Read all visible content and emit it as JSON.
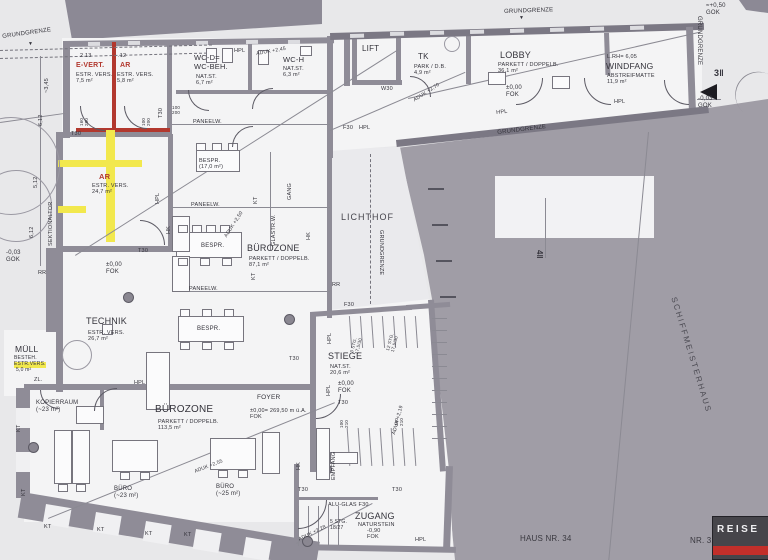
{
  "colors": {
    "paper": "#e8e8ea",
    "floor": "#f4f4f5",
    "wall": "#8f8c97",
    "wallD": "#7b7884",
    "ink": "#34333b",
    "red": "#b2382e",
    "yellow": "#f2e84d",
    "gray": "#a09da6",
    "mass": "#8c8995",
    "court": "#eaeaed",
    "white": "#f2f2f4",
    "win": "#dcdce0",
    "winB": "#f0f0f2",
    "line": "#55545e"
  },
  "footer": {
    "logo_text": "REISE",
    "house_left": "HAUS NR. 34",
    "house_right": "NR. 32"
  },
  "labels": [
    {
      "n": "grundgrenze-top-left",
      "t": "GRUNDGRENZE",
      "x": 2,
      "y": 34,
      "s": 6,
      "r": -8
    },
    {
      "n": "boundary-arrow-left",
      "t": "▼",
      "x": 28,
      "y": 42,
      "s": 5
    },
    {
      "n": "grundgrenze-top",
      "t": "GRUNDGRENZE",
      "x": 504,
      "y": 9,
      "s": 6,
      "r": -2
    },
    {
      "n": "boundary-arrow-top",
      "t": "▼",
      "x": 519,
      "y": 16,
      "s": 5
    },
    {
      "n": "grundgrenze-right",
      "t": "GRUNDGRENZE",
      "x": 702,
      "y": 16,
      "s": 6,
      "r": 90
    },
    {
      "n": "grundgrenze-diagonal",
      "t": "GRUNDGRENZE",
      "x": 497,
      "y": 130,
      "s": 6,
      "r": -7
    },
    {
      "n": "grundgrenze-lichthof",
      "t": "GRUNDGRENZE",
      "x": 384,
      "y": 230,
      "s": 5.5,
      "r": 90
    },
    {
      "n": "level-plus050-gok",
      "t": "≈+0,50\nGOK",
      "x": 706,
      "y": 3,
      "s": 6
    },
    {
      "n": "level-minus003-gok-right",
      "t": "-0,03\nGOK",
      "x": 698,
      "y": 96,
      "s": 6
    },
    {
      "n": "level-minus003-gok-left",
      "t": "-0,03\nGOK",
      "x": 6,
      "y": 250,
      "s": 6
    },
    {
      "n": "section-marker-3",
      "t": "3‖",
      "x": 714,
      "y": 68,
      "s": 9,
      "b": 1
    },
    {
      "n": "section-marker-4",
      "t": "4‖",
      "x": 544,
      "y": 250,
      "s": 8,
      "b": 1,
      "r": 90
    },
    {
      "n": "schiffmeisterhaus-label",
      "t": "SCHIFFMEISTERHAUS",
      "x": 678,
      "y": 296,
      "s": 8,
      "r": 73,
      "ls": 2,
      "c": "#4b4a52"
    },
    {
      "n": "room-evert-title",
      "t": "E-VERT.",
      "x": 76,
      "y": 62,
      "s": 7,
      "b": 1,
      "c": "#b2382e"
    },
    {
      "n": "room-evert-details",
      "t": "ESTR. VERS.\n7,5 m²",
      "x": 76,
      "y": 72,
      "s": 5.5
    },
    {
      "n": "room-ar1-title",
      "t": "AR",
      "x": 120,
      "y": 62,
      "s": 7,
      "b": 1,
      "c": "#b2382e"
    },
    {
      "n": "room-ar1-details",
      "t": "ESTR. VERS.\n5,8 m²",
      "x": 117,
      "y": 72,
      "s": 5.5
    },
    {
      "n": "room-wcd-title",
      "t": "WC-D=\nWC-BEH.",
      "x": 194,
      "y": 54,
      "s": 7.5
    },
    {
      "n": "room-wcd-details",
      "t": "NAT.ST.\n6,7 m²",
      "x": 196,
      "y": 74,
      "s": 5.5
    },
    {
      "n": "room-wch-title",
      "t": "WC-H",
      "x": 283,
      "y": 56,
      "s": 7.5
    },
    {
      "n": "room-wch-details",
      "t": "NAT.ST.\n6,3 m²",
      "x": 283,
      "y": 66,
      "s": 5.5
    },
    {
      "n": "room-lift-title",
      "t": "LIFT",
      "x": 362,
      "y": 44,
      "s": 8
    },
    {
      "n": "room-tk-title",
      "t": "TK",
      "x": 418,
      "y": 52,
      "s": 8
    },
    {
      "n": "room-tk-details",
      "t": "PARK / D.B.\n4,9 m²",
      "x": 414,
      "y": 64,
      "s": 5.5
    },
    {
      "n": "room-lobby-title",
      "t": "LOBBY",
      "x": 500,
      "y": 50,
      "s": 9
    },
    {
      "n": "room-lobby-details",
      "t": "PARKETT / DOPPELB.\n36,1 m²",
      "x": 498,
      "y": 62,
      "s": 5.5
    },
    {
      "n": "level-lobby",
      "t": "±0,00\nFOK",
      "x": 506,
      "y": 85,
      "s": 6
    },
    {
      "n": "windfang-lrh",
      "t": "L.RH= 6,05",
      "x": 607,
      "y": 54,
      "s": 5.5
    },
    {
      "n": "room-windfang-title",
      "t": "WINDFANG",
      "x": 606,
      "y": 61,
      "s": 8.5
    },
    {
      "n": "room-windfang-details",
      "t": "ABSTREIFMATTE\n11,9 m²",
      "x": 607,
      "y": 73,
      "s": 5.5
    },
    {
      "n": "room-ar2-title",
      "t": "AR",
      "x": 99,
      "y": 173,
      "s": 7.5,
      "b": 1,
      "c": "#b2382e"
    },
    {
      "n": "room-ar2-details",
      "t": "ESTR. VERS.\n24,7 m²",
      "x": 92,
      "y": 183,
      "s": 5.5
    },
    {
      "n": "room-muell-title",
      "t": "MÜLL",
      "x": 15,
      "y": 344,
      "s": 8.5
    },
    {
      "n": "room-muell-besteh",
      "t": "BESTEH.",
      "x": 14,
      "y": 356,
      "s": 5
    },
    {
      "n": "room-muell-estr",
      "t": "ESTR.VERS.",
      "x": 14,
      "y": 362,
      "s": 5,
      "bg": "#f2e84d"
    },
    {
      "n": "room-muell-area",
      "t": "5,0 m²",
      "x": 16,
      "y": 368,
      "s": 5
    },
    {
      "n": "annot-zl",
      "t": "ZL.",
      "x": 34,
      "y": 377,
      "s": 5.5
    },
    {
      "n": "room-technik-title",
      "t": "TECHNIK",
      "x": 86,
      "y": 316,
      "s": 9
    },
    {
      "n": "room-technik-details",
      "t": "ESTR. VERS.\n26,7 m²",
      "x": 88,
      "y": 330,
      "s": 5.5
    },
    {
      "n": "level-technik",
      "t": "±0,00\nFOK",
      "x": 106,
      "y": 262,
      "s": 6
    },
    {
      "n": "room-bespr-title",
      "t": "BESPR.\n(17,0 m²)",
      "x": 199,
      "y": 158,
      "s": 5.5
    },
    {
      "n": "table-bespr-1",
      "t": "BESPR.",
      "x": 201,
      "y": 243,
      "s": 6
    },
    {
      "n": "table-bespr-2",
      "t": "BESPR.",
      "x": 197,
      "y": 326,
      "s": 6
    },
    {
      "n": "room-buerozone1-title",
      "t": "BÜROZONE",
      "x": 247,
      "y": 243,
      "s": 9
    },
    {
      "n": "room-buerozone1-details",
      "t": "PARKETT / DOPPELB.\n87,1 m²",
      "x": 249,
      "y": 256,
      "s": 5.5
    },
    {
      "n": "court-lichthof-title",
      "t": "LICHTHOF",
      "x": 341,
      "y": 212,
      "s": 9,
      "ls": 1,
      "c": "#45444c"
    },
    {
      "n": "room-stiege-title",
      "t": "STIEGE",
      "x": 328,
      "y": 351,
      "s": 9
    },
    {
      "n": "room-stiege-details",
      "t": "NAT.ST.\n20,6 m²",
      "x": 330,
      "y": 364,
      "s": 5.5
    },
    {
      "n": "level-stiege",
      "t": "±0,00\nFOK",
      "x": 338,
      "y": 381,
      "s": 6
    },
    {
      "n": "room-foyer-title",
      "t": "FOYER",
      "x": 257,
      "y": 394,
      "s": 6.5
    },
    {
      "n": "level-foyer",
      "t": "±0,00= 269,50 m ü.A.\nFOK",
      "x": 250,
      "y": 408,
      "s": 5.5
    },
    {
      "n": "room-kopierraum-title",
      "t": "KOPIERRAUM\n(~23 m²)",
      "x": 36,
      "y": 400,
      "s": 6
    },
    {
      "n": "room-buerozone2-title",
      "t": "BÜROZONE",
      "x": 155,
      "y": 404,
      "s": 10
    },
    {
      "n": "room-buerozone2-details",
      "t": "PARKETT / DOPPELB.\n113,5 m²",
      "x": 158,
      "y": 419,
      "s": 5.5
    },
    {
      "n": "room-buero1-title",
      "t": "BÜRO\n(~23 m²)",
      "x": 114,
      "y": 486,
      "s": 6
    },
    {
      "n": "room-buero2-title",
      "t": "BÜRO\n(~25 m²)",
      "x": 216,
      "y": 484,
      "s": 6
    },
    {
      "n": "room-zugang-title",
      "t": "ZUGANG",
      "x": 355,
      "y": 511,
      "s": 9
    },
    {
      "n": "room-zugang-details",
      "t": "NATURSTEIN",
      "x": 358,
      "y": 522,
      "s": 5.5
    },
    {
      "n": "level-zugang",
      "t": "-0,90\nFOK",
      "x": 367,
      "y": 528,
      "s": 5.5
    },
    {
      "n": "stairs-zugang",
      "t": "5 STG.\n18/27",
      "x": 330,
      "y": 520,
      "s": 5
    },
    {
      "n": "annot-alu-glas",
      "t": "ALU-GLAS F30",
      "x": 328,
      "y": 502,
      "s": 5.5
    },
    {
      "n": "annot-empfang",
      "t": "EMPFANG",
      "x": 331,
      "y": 480,
      "s": 5.5,
      "r": -90
    },
    {
      "n": "stairs-stiege-1",
      "t": "3 STG.\n17,5/30",
      "x": 349,
      "y": 352,
      "s": 4.5,
      "r": -75
    },
    {
      "n": "stairs-stiege-2",
      "t": "12 STG.\n17,5/30",
      "x": 385,
      "y": 350,
      "s": 4.5,
      "r": -75
    },
    {
      "n": "annot-hpl-1",
      "t": "HPL",
      "x": 234,
      "y": 48,
      "s": 5.5
    },
    {
      "n": "annot-f30-1",
      "t": "F30",
      "x": 343,
      "y": 125,
      "s": 5.5
    },
    {
      "n": "annot-hpl-2",
      "t": "HPL",
      "x": 359,
      "y": 125,
      "s": 5.5
    },
    {
      "n": "annot-hpl-3",
      "t": "HPL",
      "x": 496,
      "y": 110,
      "s": 5.5,
      "r": -6
    },
    {
      "n": "annot-hpl-4",
      "t": "HPL",
      "x": 614,
      "y": 99,
      "s": 5.5
    },
    {
      "n": "annot-hpl-5",
      "t": "HPL",
      "x": 134,
      "y": 380,
      "s": 5.5
    },
    {
      "n": "annot-hpl-6",
      "t": "HPL",
      "x": 327,
      "y": 344,
      "s": 5.5,
      "r": -90
    },
    {
      "n": "annot-hpl-7",
      "t": "HPL",
      "x": 326,
      "y": 396,
      "s": 5.5,
      "r": -90
    },
    {
      "n": "annot-hpl-8",
      "t": "HPL",
      "x": 415,
      "y": 537,
      "s": 5.5
    },
    {
      "n": "annot-hpl-9",
      "t": "HPL",
      "x": 155,
      "y": 204,
      "s": 5.5,
      "r": -90
    },
    {
      "n": "annot-paneelw-1",
      "t": "PANEELW.",
      "x": 193,
      "y": 119,
      "s": 5.5
    },
    {
      "n": "annot-paneelw-2",
      "t": "PANEELW.",
      "x": 191,
      "y": 202,
      "s": 5.5
    },
    {
      "n": "annot-paneelw-3",
      "t": "PANEELW.",
      "x": 189,
      "y": 286,
      "s": 5.5
    },
    {
      "n": "annot-sektionaltor",
      "t": "SEKTIONALTOR",
      "x": 48,
      "y": 246,
      "s": 5.5,
      "r": -90
    },
    {
      "n": "annot-glastrw",
      "t": "GLASTR.W.",
      "x": 271,
      "y": 246,
      "s": 5.5,
      "r": -90
    },
    {
      "n": "annot-gang",
      "t": "GANG",
      "x": 287,
      "y": 200,
      "s": 5.5,
      "r": -90
    },
    {
      "n": "annot-w30",
      "t": "W30",
      "x": 381,
      "y": 86,
      "s": 5.5
    },
    {
      "n": "annot-f30-2",
      "t": "F30",
      "x": 344,
      "y": 302,
      "s": 5.5
    },
    {
      "n": "annot-kt-1",
      "t": "KT",
      "x": 253,
      "y": 204,
      "s": 5.5,
      "r": -90
    },
    {
      "n": "annot-kt-2",
      "t": "KT",
      "x": 251,
      "y": 280,
      "s": 5.5,
      "r": -90
    },
    {
      "n": "annot-hk-1",
      "t": "HK",
      "x": 306,
      "y": 240,
      "s": 5.5,
      "r": -90
    },
    {
      "n": "annot-hk-2",
      "t": "HK",
      "x": 296,
      "y": 470,
      "s": 5.5,
      "r": -90
    },
    {
      "n": "annot-hk-3",
      "t": "HK",
      "x": 166,
      "y": 234,
      "s": 5.5,
      "r": -90
    },
    {
      "n": "annot-rr-1",
      "t": "RR",
      "x": 38,
      "y": 270,
      "s": 5.5
    },
    {
      "n": "annot-rr-2",
      "t": "RR",
      "x": 332,
      "y": 282,
      "s": 5.5
    },
    {
      "n": "annot-kt-3",
      "t": "KT",
      "x": 16,
      "y": 432,
      "s": 5.5,
      "r": -90
    },
    {
      "n": "annot-kt-4",
      "t": "KT",
      "x": 21,
      "y": 496,
      "s": 5.5,
      "r": -90
    },
    {
      "n": "annot-kt-5",
      "t": "KT",
      "x": 44,
      "y": 524,
      "s": 5.5
    },
    {
      "n": "annot-kt-6",
      "t": "KT",
      "x": 97,
      "y": 527,
      "s": 5.5
    },
    {
      "n": "annot-kt-7",
      "t": "KT",
      "x": 145,
      "y": 531,
      "s": 5.5
    },
    {
      "n": "annot-kt-8",
      "t": "KT",
      "x": 184,
      "y": 532,
      "s": 5.5
    },
    {
      "n": "level-aduk-1",
      "t": "ADUK +2,45",
      "x": 256,
      "y": 52,
      "s": 5,
      "r": -10
    },
    {
      "n": "level-aduk-2",
      "t": "ADUK +2,70",
      "x": 413,
      "y": 99,
      "s": 5,
      "r": -33
    },
    {
      "n": "level-aduk-3",
      "t": "ADUK +2,50",
      "x": 224,
      "y": 236,
      "s": 5,
      "r": -57
    },
    {
      "n": "level-aduk-4",
      "t": "ADUK +2,55",
      "x": 194,
      "y": 470,
      "s": 5,
      "r": -21
    },
    {
      "n": "level-aduk-5",
      "t": "ADUK +2,28",
      "x": 298,
      "y": 538,
      "s": 5,
      "r": -26
    },
    {
      "n": "level-aduk-6",
      "t": "ADUK +2,19",
      "x": 392,
      "y": 434,
      "s": 5,
      "r": -75
    },
    {
      "n": "dim-213",
      "t": "2.13",
      "x": 80,
      "y": 53,
      "s": 5.5
    },
    {
      "n": "dim-12",
      "t": ".12",
      "x": 118,
      "y": 53,
      "s": 5.5
    },
    {
      "n": "dim-345",
      "t": "~3,45",
      "x": 44,
      "y": 93,
      "s": 5.5,
      "r": -90
    },
    {
      "n": "dim-612a",
      "t": "6,12",
      "x": 38,
      "y": 126,
      "s": 5.5,
      "r": -90
    },
    {
      "n": "dim-512",
      "t": "5,12",
      "x": 33,
      "y": 188,
      "s": 5.5,
      "r": -90
    },
    {
      "n": "dim-612b",
      "t": "6,12",
      "x": 29,
      "y": 238,
      "s": 5.5,
      "r": -90
    },
    {
      "n": "dim-door-160200",
      "t": "160\n200",
      "x": 79,
      "y": 126,
      "s": 4.5,
      "r": -90
    },
    {
      "n": "dim-door-100200a",
      "t": "100\n200",
      "x": 141,
      "y": 126,
      "s": 4.5,
      "r": -90
    },
    {
      "n": "dim-door-100200b",
      "t": "100\n200",
      "x": 172,
      "y": 105,
      "s": 4.5
    },
    {
      "n": "dim-door-100210a",
      "t": "100\n210",
      "x": 339,
      "y": 428,
      "s": 4.5,
      "r": -90
    },
    {
      "n": "dim-door-100210b",
      "t": "100\n210",
      "x": 394,
      "y": 426,
      "s": 4.5,
      "r": -90
    },
    {
      "n": "door-t30-1",
      "t": "T30",
      "x": 71,
      "y": 131,
      "s": 5.5
    },
    {
      "n": "door-t30-2",
      "t": "T30",
      "x": 158,
      "y": 118,
      "s": 5.5,
      "r": -90
    },
    {
      "n": "door-t30-3",
      "t": "T30",
      "x": 138,
      "y": 248,
      "s": 5.5
    },
    {
      "n": "door-t30-4",
      "t": "T30",
      "x": 289,
      "y": 356,
      "s": 5.5
    },
    {
      "n": "door-t30-5",
      "t": "T30",
      "x": 338,
      "y": 400,
      "s": 5.5
    },
    {
      "n": "door-t30-6",
      "t": "T30",
      "x": 298,
      "y": 487,
      "s": 5.5
    },
    {
      "n": "door-t30-7",
      "t": "T30",
      "x": 392,
      "y": 487,
      "s": 5.5
    },
    {
      "n": "house-nr-34",
      "t": "HAUS NR. 34",
      "x": 520,
      "y": 534,
      "s": 8,
      "c": "#3a3940"
    },
    {
      "n": "house-nr-32",
      "t": "NR. 32",
      "x": 690,
      "y": 536,
      "s": 8,
      "c": "#3a3940"
    }
  ]
}
